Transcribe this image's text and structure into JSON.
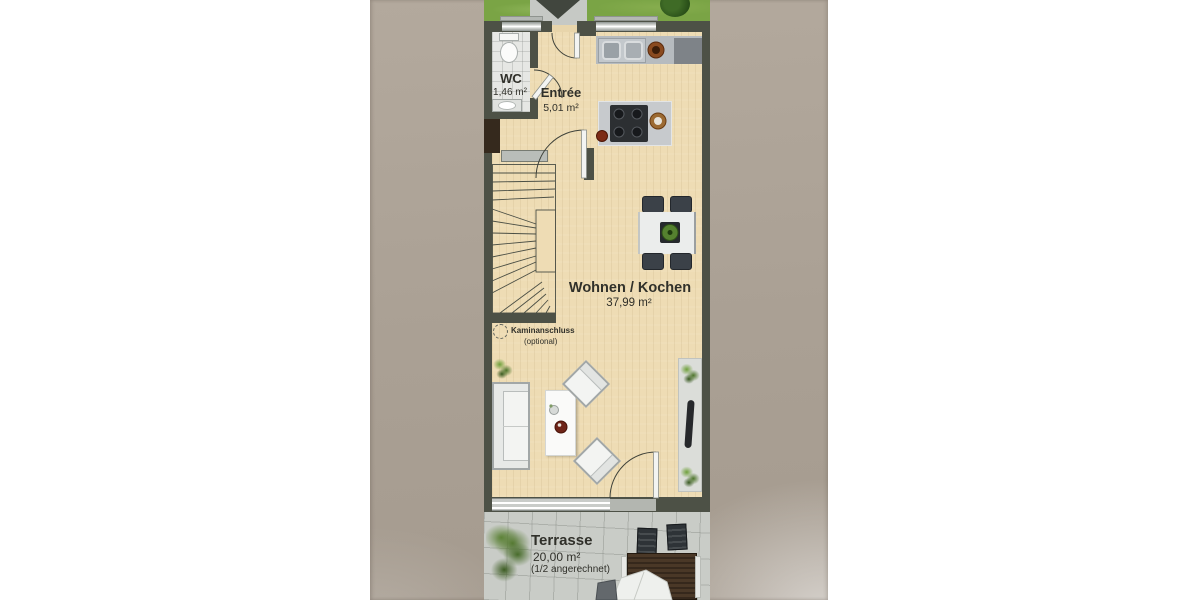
{
  "rooms": {
    "wc": {
      "name": "WC",
      "area": "1,46 m²"
    },
    "entree": {
      "name": "Entrée",
      "area": "5,01 m²"
    },
    "wohnen_kochen": {
      "name": "Wohnen / Kochen",
      "area": "37,99 m²"
    },
    "terrasse": {
      "name": "Terrasse",
      "area": "20,00 m²",
      "note": "(1/2 angerechnet)"
    }
  },
  "annotations": {
    "kaminanschluss": {
      "line1": "Kaminanschluss",
      "line2": "(optional)"
    }
  },
  "icons": {
    "entrance_marker": "triangle-down",
    "kamin_symbol": "dashed-circle"
  },
  "colors": {
    "page": "#ffffff",
    "paper": "#aba094",
    "wall": "#4d5146",
    "floor": "#eedcb4",
    "grass": "#7aa445",
    "path": "#c6c9c5",
    "marker": "#41463e",
    "paver": "#c9ccc7",
    "counter": "#b6bbbf",
    "counter_dark": "#7e8388",
    "text": "#30302a"
  }
}
